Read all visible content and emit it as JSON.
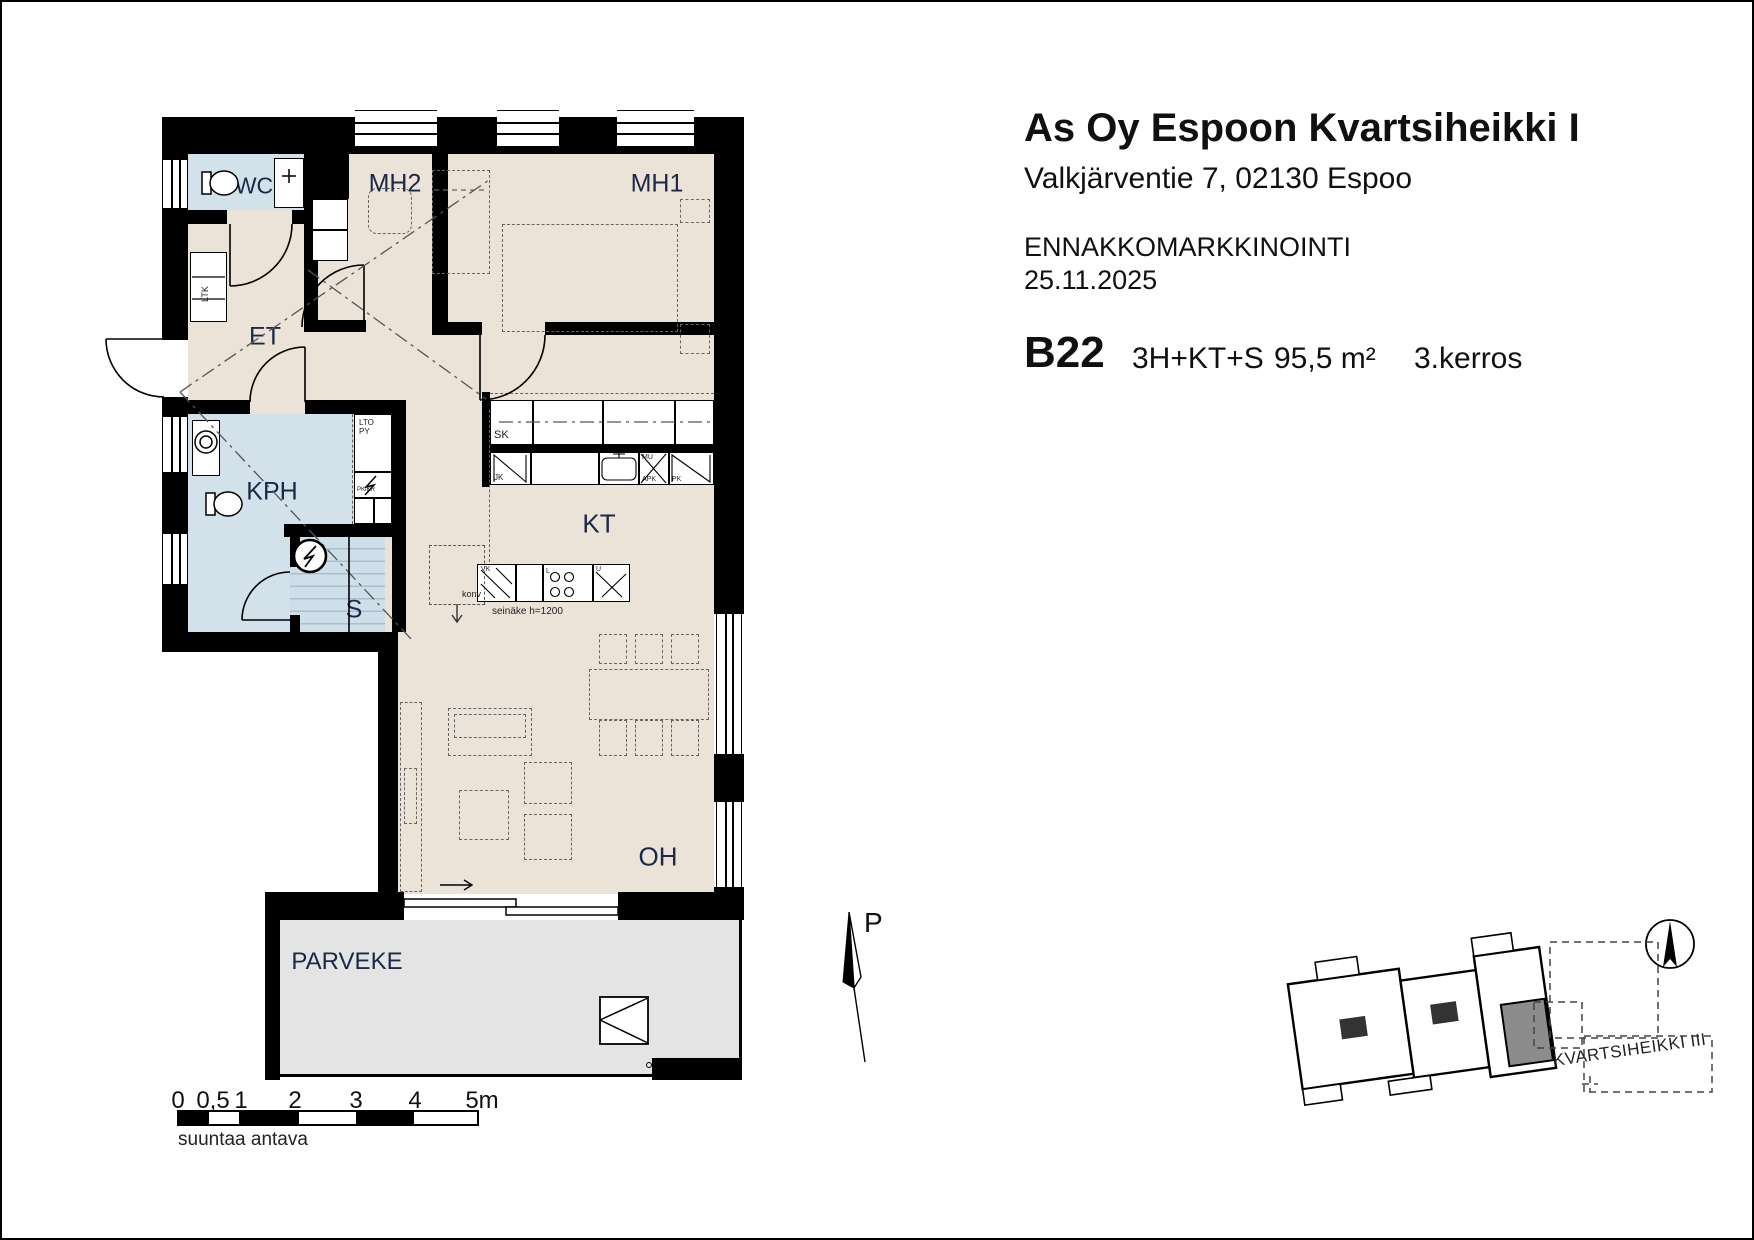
{
  "header": {
    "title": "As Oy Espoon Kvartsiheikki I",
    "address": "Valkjärventie 7, 02130 Espoo",
    "phase": "ENNAKKOMARKKINOINTI",
    "date": "25.11.2025",
    "apartment_id": "B22",
    "apartment_type": "3H+KT+S",
    "area": "95,5 m²",
    "floor": "3.kerros"
  },
  "rooms": {
    "wc": "WC",
    "mh2": "MH2",
    "mh1": "MH1",
    "et": "ET",
    "kph": "KPH",
    "s": "S",
    "kt": "KT",
    "oh": "OH",
    "parveke": "PARVEKE"
  },
  "plan_labels": {
    "sk": "SK",
    "jk": "JK",
    "mu": "MU",
    "apk": "APK",
    "pk": "PK",
    "ltk": "LTK",
    "lto": "LTO",
    "py": "PY",
    "pk_kr": "PK/KR",
    "vk": "VK",
    "l": "L",
    "u": "U",
    "konv": "konv",
    "seinake": "seinäke h=1200"
  },
  "north_arrow": {
    "label": "P"
  },
  "scale_bar": {
    "ticks": [
      "0",
      "0,5",
      "1",
      "2",
      "3",
      "4",
      "5m"
    ],
    "note": "suuntaa antava"
  },
  "site_plan": {
    "label": "KVARTSIHEIKKI III"
  }
}
